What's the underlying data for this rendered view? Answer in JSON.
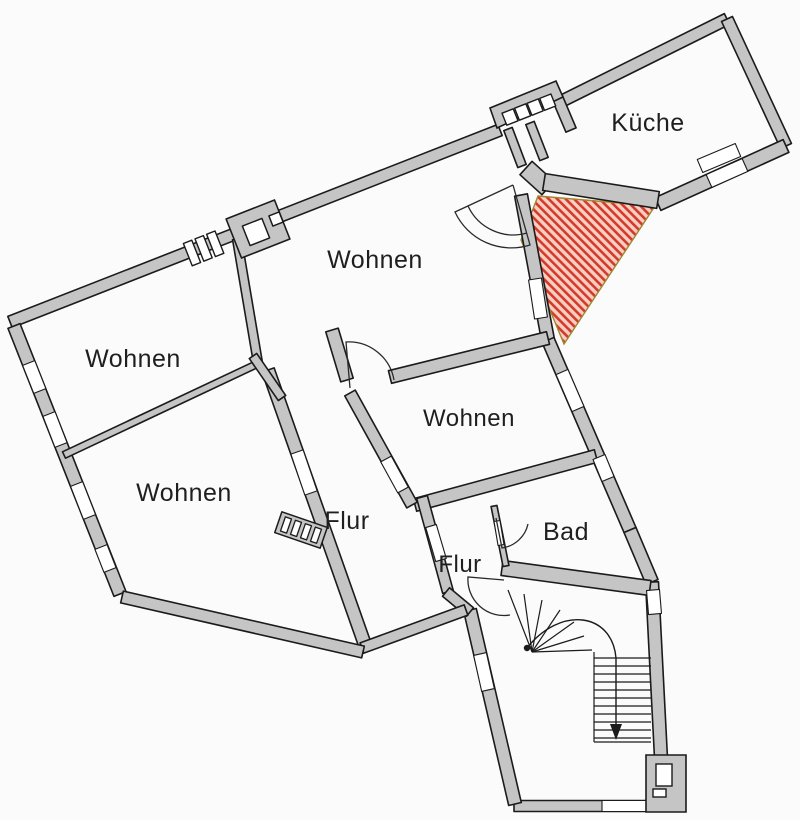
{
  "title": "Wohnung Grundriss (floor plan)",
  "rooms": [
    {
      "id": "kueche",
      "label": "Küche",
      "x": 648,
      "y": 131
    },
    {
      "id": "wohnen-center",
      "label": "Wohnen",
      "x": 375,
      "y": 268
    },
    {
      "id": "wohnen-left",
      "label": "Wohnen",
      "x": 133,
      "y": 367
    },
    {
      "id": "wohnen-bottom",
      "label": "Wohnen",
      "x": 184,
      "y": 501
    },
    {
      "id": "wohnen-small",
      "label": "Wohnen",
      "x": 469,
      "y": 426
    },
    {
      "id": "flur-main",
      "label": "Flur",
      "x": 347,
      "y": 529
    },
    {
      "id": "flur-small",
      "label": "Flur",
      "x": 460,
      "y": 572
    },
    {
      "id": "bad",
      "label": "Bad",
      "x": 566,
      "y": 540
    }
  ],
  "highlight": {
    "name": "terrace-highlight",
    "hatch_color": "#d43a2c",
    "hatch_background": "#f6cfc2",
    "edge_color": "#a08830"
  },
  "colors": {
    "wall_fill": "#c5c5c5",
    "outline": "#1b1b1b",
    "background": "#fbfbfb",
    "label": "#1f1f1f"
  },
  "stairs": {
    "direction_arrow": "down"
  }
}
